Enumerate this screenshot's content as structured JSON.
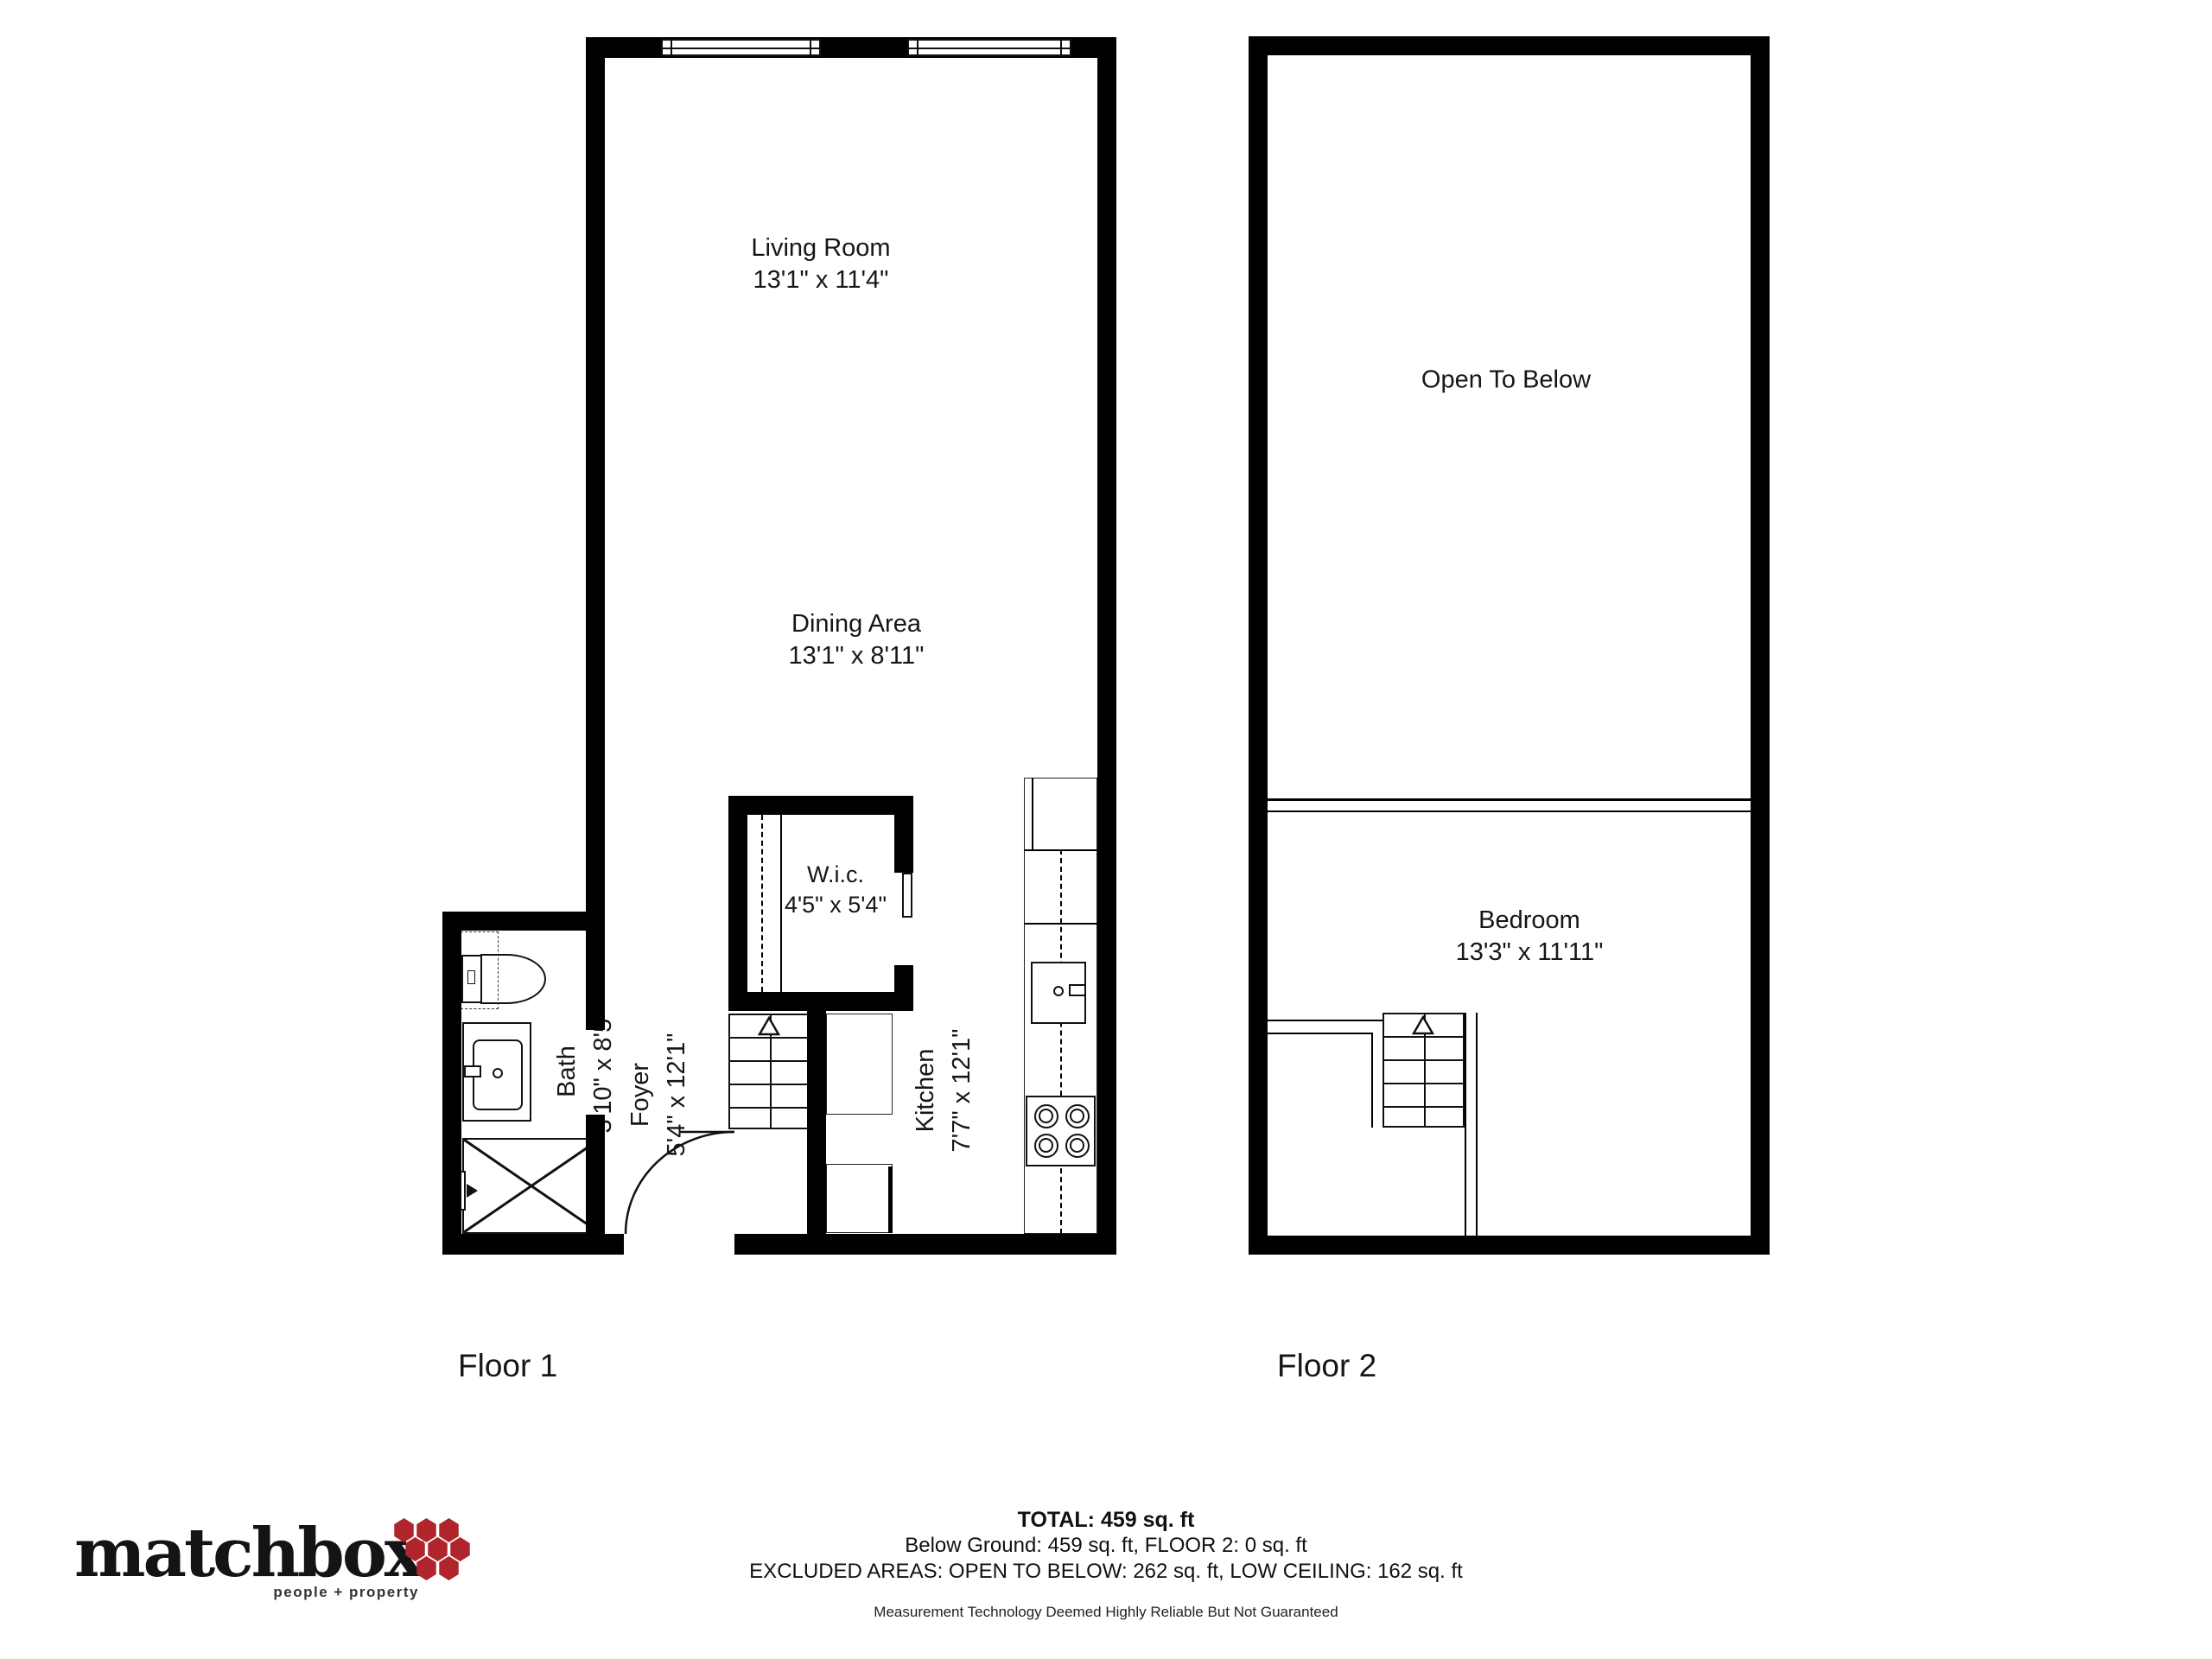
{
  "floor1": {
    "label": "Floor 1",
    "living_room": {
      "name": "Living Room",
      "dims": "13'1\" x 11'4\""
    },
    "dining_area": {
      "name": "Dining Area",
      "dims": "13'1\" x 8'11\""
    },
    "wic": {
      "name": "W.i.c.",
      "dims": "4'5\" x 5'4\""
    },
    "kitchen": {
      "name": "Kitchen",
      "dims": "7'7\" x 12'1\""
    },
    "foyer": {
      "name": "Foyer",
      "dims": "5'4\" x 12'1\""
    },
    "bath": {
      "name": "Bath",
      "dims": "3'10\" x 8'5\""
    }
  },
  "floor2": {
    "label": "Floor 2",
    "open_to_below": {
      "name": "Open To Below"
    },
    "bedroom": {
      "name": "Bedroom",
      "dims": "13'3\" x 11'11\""
    }
  },
  "summary": {
    "total": "TOTAL: 459 sq. ft",
    "breakdown": "Below Ground: 459 sq. ft, FLOOR 2: 0 sq. ft",
    "excluded": "EXCLUDED AREAS: OPEN TO BELOW: 262 sq. ft, LOW CEILING: 162 sq. ft",
    "disclaimer": "Measurement Technology Deemed Highly Reliable But Not Guaranteed"
  },
  "logo": {
    "brand": "matchbox",
    "tagline": "people + property",
    "accent_color": "#b0252c"
  }
}
